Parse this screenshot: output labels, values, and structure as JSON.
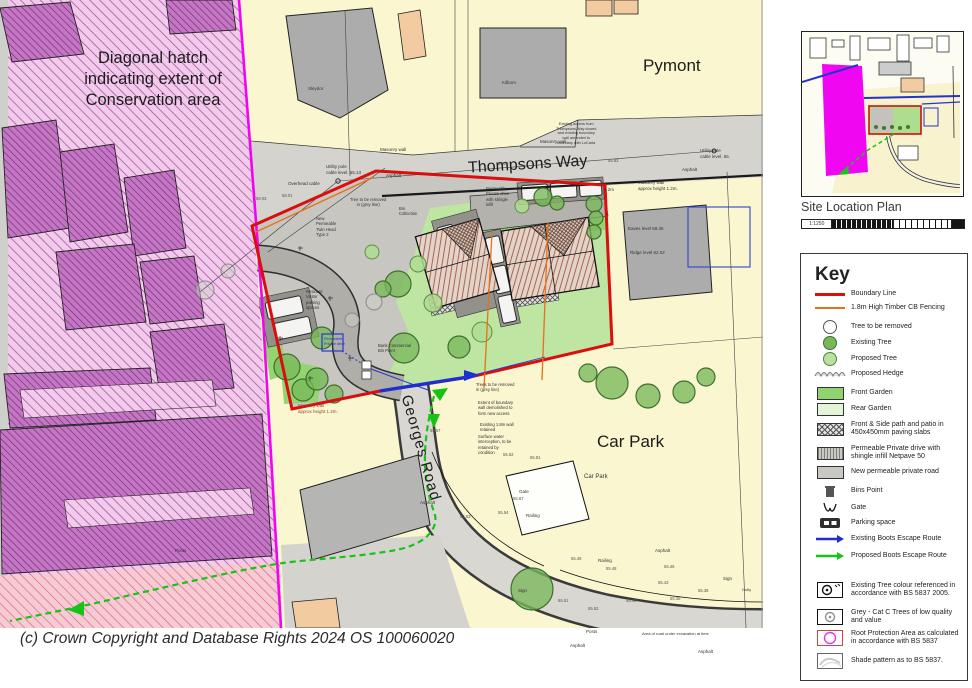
{
  "page": {
    "copyright": "(c) Crown Copyright and Database Rights 2024 OS 100060020"
  },
  "map": {
    "conservation_note": "Diagonal hatch\nindicating extent of\nConservation area",
    "labels": {
      "pymont": "Pymont",
      "thompsons_way": "Thompsons Way",
      "georges_road": "Georges Road",
      "car_park": "Car Park"
    },
    "annotations": [
      {
        "t": "Sleydor",
        "x": 308,
        "y": 86,
        "fs": 4.5
      },
      {
        "t": "Kilborn",
        "x": 502,
        "y": 80,
        "fs": 4.5
      },
      {
        "t": "Overhead cable",
        "x": 288,
        "y": 181,
        "fs": 4.5
      },
      {
        "t": "Utility pole\ncable level. 65.13",
        "x": 326,
        "y": 164,
        "fs": 4.5
      },
      {
        "t": "Utility pole\ncable level. 65.",
        "x": 700,
        "y": 148,
        "fs": 4.5
      },
      {
        "t": "Masonry wall",
        "x": 380,
        "y": 147,
        "fs": 4.5
      },
      {
        "t": "Masonry wall",
        "x": 540,
        "y": 139,
        "fs": 4.5
      },
      {
        "t": "Masonry wall\napprox height 1.2m.",
        "x": 638,
        "y": 180,
        "fs": 4.5
      },
      {
        "t": "Masonry wall\napprox height 1.2m.",
        "x": 298,
        "y": 403,
        "fs": 4.5,
        "c": "#8B4A2F"
      },
      {
        "t": "Asphalt",
        "x": 386,
        "y": 173,
        "fs": 4.5
      },
      {
        "t": "Asphalt",
        "x": 682,
        "y": 167,
        "fs": 4.5
      },
      {
        "t": "Asphalt",
        "x": 420,
        "y": 500,
        "fs": 4.5
      },
      {
        "t": "Asphalt",
        "x": 655,
        "y": 548,
        "fs": 4.5
      },
      {
        "t": "Asphalt",
        "x": 570,
        "y": 643,
        "fs": 4.5
      },
      {
        "t": "Asphalt",
        "x": 698,
        "y": 649,
        "fs": 4.5
      },
      {
        "t": "Existing access from\nThompsons Way closed\nand existing boundary\nwall amended to\nboundary with LoCarta",
        "x": 556,
        "y": 122,
        "fs": 3.8,
        "al": "center"
      },
      {
        "t": "New\nPermeable\nTwin Head\nType 2",
        "x": 316,
        "y": 216,
        "fs": 4.2
      },
      {
        "t": "Tree to be removed\nin (grey line)",
        "x": 350,
        "y": 197,
        "fs": 4.2,
        "al": "center"
      },
      {
        "t": "Trees to be removed\nin (grey line)",
        "x": 476,
        "y": 382,
        "fs": 4.2
      },
      {
        "t": "Extent of boundary\nwall demolished to\nform new access",
        "x": 478,
        "y": 400,
        "fs": 4.2
      },
      {
        "t": "Existing 1.8m wall\nretained",
        "x": 480,
        "y": 422,
        "fs": 4.2
      },
      {
        "t": "Surface water\ninterception, to be\nretained by\ncondition",
        "x": 478,
        "y": 434,
        "fs": 4.2
      },
      {
        "t": "Permeable\nPrivate drive\nwith shingle\ninfill",
        "x": 486,
        "y": 186,
        "fs": 4.2
      },
      {
        "t": "Bin\nCollection",
        "x": 399,
        "y": 206,
        "fs": 4.2
      },
      {
        "t": "Resident\nVisitor\nparking\nspaces",
        "x": 306,
        "y": 289,
        "fs": 4.2
      },
      {
        "t": "Bank Commercial\nBin Point",
        "x": 378,
        "y": 343,
        "fs": 4.2
      },
      {
        "t": "Eaves level  58.36",
        "x": 628,
        "y": 226,
        "fs": 4.5
      },
      {
        "t": "Ridge level  62.02",
        "x": 630,
        "y": 250,
        "fs": 4.5
      },
      {
        "t": "Gate",
        "x": 519,
        "y": 489,
        "fs": 4.5
      },
      {
        "t": "Railing",
        "x": 526,
        "y": 513,
        "fs": 4.5
      },
      {
        "t": "Railing",
        "x": 598,
        "y": 558,
        "fs": 4.5
      },
      {
        "t": "Posts",
        "x": 175,
        "y": 548,
        "fs": 4.5
      },
      {
        "t": "Posts",
        "x": 586,
        "y": 629,
        "fs": 4.5
      },
      {
        "t": "Sign",
        "x": 723,
        "y": 576,
        "fs": 4.5
      },
      {
        "t": "Sign",
        "x": 518,
        "y": 588,
        "fs": 4.5
      },
      {
        "t": "Car Park",
        "x": 584,
        "y": 474,
        "fs": 6
      },
      {
        "t": "Area of road under excavation at time",
        "x": 642,
        "y": 631,
        "fs": 4
      },
      {
        "t": "Gully",
        "x": 742,
        "y": 587,
        "fs": 4
      },
      {
        "t": "1.2m",
        "x": 604,
        "y": 187,
        "fs": 4.5
      },
      {
        "t": "Permeable\nPrivate drive",
        "x": 324,
        "y": 337,
        "fs": 3.8,
        "c": "#2233CC"
      },
      {
        "t": "58.03",
        "x": 256,
        "y": 196,
        "fs": 4.2,
        "c": "#555"
      },
      {
        "t": "58.01",
        "x": 282,
        "y": 193,
        "fs": 4.2,
        "c": "#555"
      },
      {
        "t": "57.05",
        "x": 498,
        "y": 161,
        "fs": 4.2,
        "c": "#555"
      },
      {
        "t": "55.93",
        "x": 608,
        "y": 158,
        "fs": 4.2,
        "c": "#555"
      },
      {
        "t": "55.62",
        "x": 503,
        "y": 452,
        "fs": 4.2,
        "c": "#555"
      },
      {
        "t": "55.81",
        "x": 530,
        "y": 455,
        "fs": 4.2,
        "c": "#555"
      },
      {
        "t": "55.57",
        "x": 430,
        "y": 428,
        "fs": 4.2,
        "c": "#555"
      },
      {
        "t": "55.67",
        "x": 513,
        "y": 496,
        "fs": 4.2,
        "c": "#555"
      },
      {
        "t": "55.54",
        "x": 498,
        "y": 510,
        "fs": 4.2,
        "c": "#555"
      },
      {
        "t": "55.63",
        "x": 460,
        "y": 514,
        "fs": 4.2,
        "c": "#555"
      },
      {
        "t": "55.49",
        "x": 571,
        "y": 556,
        "fs": 4.2,
        "c": "#555"
      },
      {
        "t": "55.48",
        "x": 606,
        "y": 566,
        "fs": 4.2,
        "c": "#555"
      },
      {
        "t": "55.46",
        "x": 664,
        "y": 564,
        "fs": 4.2,
        "c": "#555"
      },
      {
        "t": "55.43",
        "x": 658,
        "y": 580,
        "fs": 4.2,
        "c": "#555"
      },
      {
        "t": "55.40",
        "x": 626,
        "y": 598,
        "fs": 4.2,
        "c": "#555"
      },
      {
        "t": "55.38",
        "x": 698,
        "y": 588,
        "fs": 4.2,
        "c": "#555"
      },
      {
        "t": "55.36",
        "x": 670,
        "y": 596,
        "fs": 4.2,
        "c": "#555"
      },
      {
        "t": "55.52",
        "x": 588,
        "y": 606,
        "fs": 4.2,
        "c": "#555"
      },
      {
        "t": "55.51",
        "x": 558,
        "y": 598,
        "fs": 4.2,
        "c": "#555"
      }
    ]
  },
  "inset": {
    "title": "Site Location Plan",
    "scale": "1:1250"
  },
  "key": {
    "title": "Key",
    "items": [
      {
        "label": "Boundary Line"
      },
      {
        "label": "1.8m High Timber CB Fencing"
      },
      {
        "label": "Tree to be removed"
      },
      {
        "label": "Existing Tree"
      },
      {
        "label": "Proposed Tree"
      },
      {
        "label": "Proposed Hedge"
      },
      {
        "label": "Front Garden"
      },
      {
        "label": "Rear Garden"
      },
      {
        "label": "Front & Side path and patio in 450x450mm paving slabs"
      },
      {
        "label": "Permeable Private drive with shingle infill Netpave 50"
      },
      {
        "label": "New permeable private road"
      },
      {
        "label": "Bins Point"
      },
      {
        "label": "Gate"
      },
      {
        "label": "Parking space"
      },
      {
        "label": "Existing Boots Escape Route"
      },
      {
        "label": "Proposed Boots Escape Route"
      },
      {
        "label": "Existing Tree colour referenced in accordance with BS 5837 2005."
      },
      {
        "label": "Grey - Cat C Trees of low quality and value"
      },
      {
        "label": "Root Protection Area as calculated in accordance with BS 5837"
      },
      {
        "label": "Shade pattern as to BS 5837."
      }
    ]
  }
}
